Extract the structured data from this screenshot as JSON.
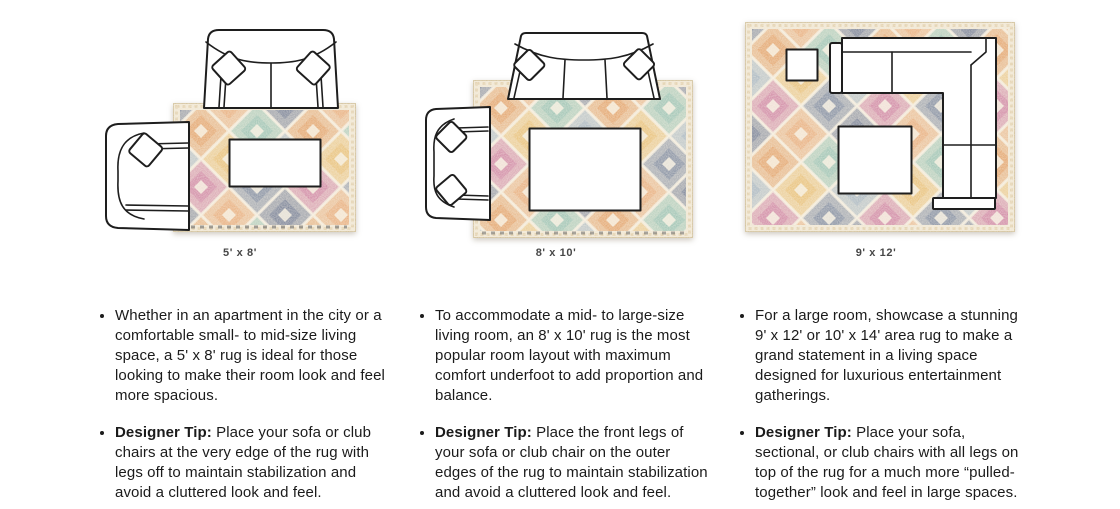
{
  "page": {
    "background": "#ffffff"
  },
  "colors": {
    "rug_base": "#efe5d0",
    "rug_border": "#dcc79e",
    "navy": "#4b5a7d",
    "navy_light": "#5a6b8c",
    "slate": "#8ba3b8",
    "orange": "#dd8a44",
    "peach": "#e3975a",
    "gold": "#e4b054",
    "rose": "#c2628f",
    "teal": "#7cb4a4",
    "line": "#1e1e1e"
  },
  "columns": [
    {
      "size_label": "5' x 8'",
      "bullet1": "Whether in an apartment in the city or a comfortable small- to mid-size living space, a 5' x 8' rug is ideal for those looking to make their room look and feel more spacious.",
      "tip_label": "Designer Tip:",
      "tip_text": " Place your sofa or club chairs at the very edge of the rug with legs off to maintain stabilization and avoid a cluttered look and feel."
    },
    {
      "size_label": "8' x 10'",
      "bullet1": "To accommodate a mid- to large-size living room, an 8' x 10' rug is the most popular room layout with maximum comfort underfoot to add proportion and balance.",
      "tip_label": "Designer Tip:",
      "tip_text": " Place the front legs of your sofa or club chair on the outer edges of the rug to maintain stabilization and avoid a cluttered look and feel."
    },
    {
      "size_label": "9' x 12'",
      "bullet1": "For a large room, showcase a stunning 9' x 12' or 10' x 14' area rug to make a grand statement in a living space designed for luxurious entertainment gatherings.",
      "tip_label": "Designer Tip:",
      "tip_text": " Place your sofa, sectional, or club chairs with all legs on top of the rug for a much more “pulled-together” look and feel in large spaces."
    }
  ]
}
